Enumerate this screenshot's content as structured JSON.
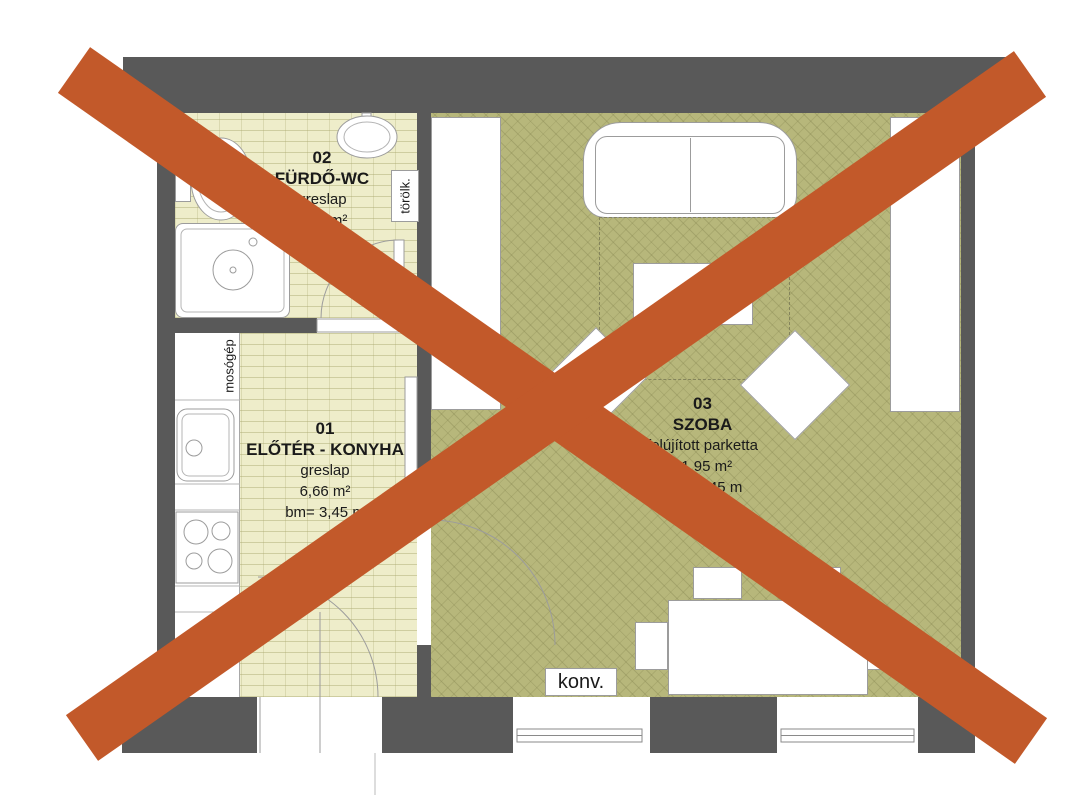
{
  "plan": {
    "rooms": [
      {
        "number": "02",
        "name": "FÜRDŐ-WC",
        "finish": "greslap",
        "area": "3,54 m²",
        "height": "bm= 3,45 m"
      },
      {
        "number": "01",
        "name": "ELŐTÉR - KONYHA",
        "finish": "greslap",
        "area": "6,66 m²",
        "height": "bm= 3,45 m"
      },
      {
        "number": "03",
        "name": "SZOBA",
        "finish": "felújított parketta",
        "area": "21,95 m²",
        "height": "bm= 3,45 m"
      }
    ],
    "annotations": {
      "towel": "törölk.",
      "washing_machine": "mosógép",
      "convector": "konv."
    }
  },
  "colors": {
    "wall": "#595959",
    "tile_floor": "#eeedca",
    "parquet_floor": "#b7b77b",
    "cross": "#c2592a",
    "outline": "#9c9c9c"
  }
}
